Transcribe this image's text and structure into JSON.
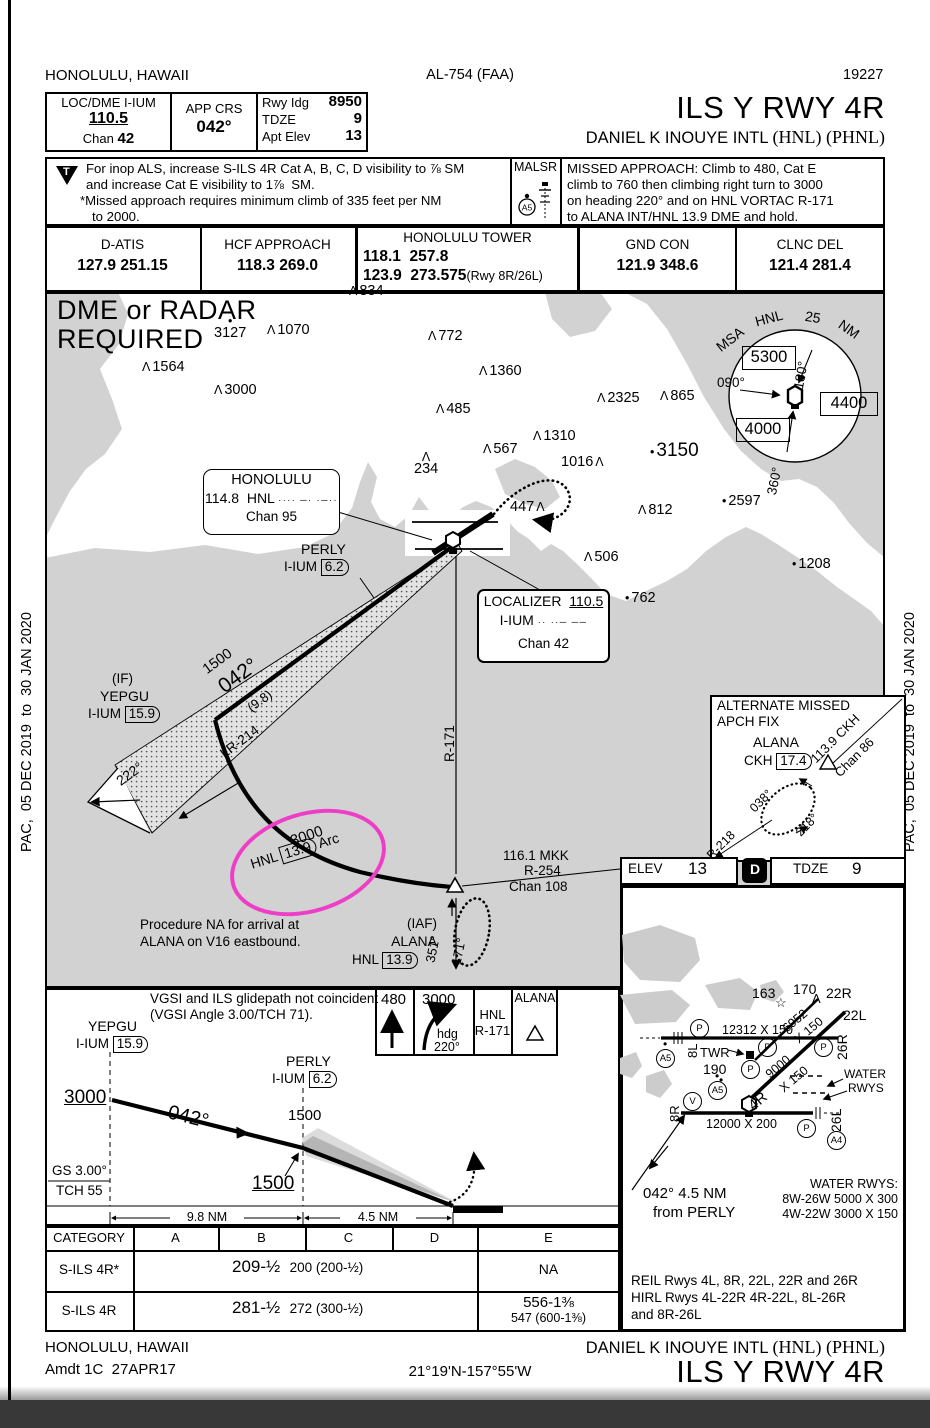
{
  "edge": {
    "left_text": "PAC,  05 DEC 2019  to  30 JAN 2020",
    "right_text": "PAC,  05 DEC 2019  to  30 JAN 2020"
  },
  "header": {
    "city": "HONOLULU, HAWAII",
    "al": "AL-754 (FAA)",
    "num": "19227"
  },
  "title": {
    "proc": "ILS Y RWY 4R",
    "airport": "DANIEL K INOUYE INTL",
    "codes": "(HNL) (PHNL)"
  },
  "briefing": {
    "loc_label": "LOC/DME I-IUM",
    "loc_freq": "110.5",
    "chan_label": "Chan",
    "chan": "42",
    "crs_label": "APP CRS",
    "crs": "042°",
    "rwy_label": "Rwy Idg",
    "rwy": "8950",
    "tdze_label": "TDZE",
    "tdze": "9",
    "elev_label": "Apt Elev",
    "elev": "13"
  },
  "notes": {
    "t": "T",
    "inop1": "For inop ALS, increase S-ILS 4R Cat A, B, C, D visibility to ⅞ SM",
    "inop2": "and increase Cat E visibility to 1⅞  SM.",
    "inop3": "*Missed approach requires minimum climb of 335 feet per NM",
    "inop4": "to 2000.",
    "malsr": "MALSR",
    "malsr_a5": "A5",
    "missed1": "MISSED APPROACH: Climb to 480, Cat E",
    "missed2": "climb to 760 then climbing right turn to 3000",
    "missed3": "on heading 220° and on HNL VORTAC R-171",
    "missed4": "to ALANA INT/HNL 13.9 DME and hold."
  },
  "freqs": {
    "datis_label": "D-ATIS",
    "datis": "127.9 251.15",
    "hcf_label": "HCF APPROACH",
    "hcf": "118.3 269.0",
    "twr_label": "HONOLULU TOWER",
    "twr1": "118.1  257.8",
    "twr2": "123.9  273.575",
    "twr2b": "(Rwy 8R/26L)",
    "gnd_label": "GND CON",
    "gnd": "121.9 348.6",
    "clnc_label": "CLNC DEL",
    "clnc": "121.4 281.4"
  },
  "planview": {
    "req1": "DME or RADAR",
    "req2": "REQUIRED",
    "spots": [
      {
        "s": "p",
        "o": "pre",
        "x": 349,
        "y": 283,
        "v": "834"
      },
      {
        "s": "d",
        "o": "above",
        "x": 214,
        "y": 316,
        "v": "3127"
      },
      {
        "s": "p",
        "o": "pre",
        "x": 267,
        "y": 322,
        "v": "1070"
      },
      {
        "s": "p",
        "o": "pre",
        "x": 428,
        "y": 328,
        "v": "772"
      },
      {
        "s": "p",
        "o": "pre",
        "x": 142,
        "y": 359,
        "v": "1564"
      },
      {
        "s": "p",
        "o": "pre",
        "x": 479,
        "y": 363,
        "v": "1360"
      },
      {
        "s": "p",
        "o": "pre",
        "x": 214,
        "y": 382,
        "v": "3000"
      },
      {
        "s": "p",
        "o": "pre",
        "x": 597,
        "y": 390,
        "v": "2325"
      },
      {
        "s": "p",
        "o": "pre",
        "x": 660,
        "y": 388,
        "v": "865"
      },
      {
        "s": "p",
        "o": "pre",
        "x": 436,
        "y": 401,
        "v": "485"
      },
      {
        "s": "p",
        "o": "pre",
        "x": 533,
        "y": 428,
        "v": "1310"
      },
      {
        "s": "p",
        "o": "pre",
        "x": 483,
        "y": 441,
        "v": "567"
      },
      {
        "s": "d",
        "o": "pre",
        "x": 650,
        "y": 440,
        "v": "3150",
        "big": true
      },
      {
        "s": "p",
        "o": "post",
        "x": 561,
        "y": 454,
        "v": "1016"
      },
      {
        "s": "p",
        "o": "above",
        "x": 414,
        "y": 452,
        "v": "234"
      },
      {
        "s": "p",
        "o": "post",
        "x": 510,
        "y": 499,
        "v": "447"
      },
      {
        "s": "p",
        "o": "pre",
        "x": 638,
        "y": 502,
        "v": "812"
      },
      {
        "s": "d",
        "o": "pre",
        "x": 722,
        "y": 493,
        "v": "2597"
      },
      {
        "s": "p",
        "o": "pre",
        "x": 584,
        "y": 549,
        "v": "506"
      },
      {
        "s": "d",
        "o": "pre",
        "x": 792,
        "y": 556,
        "v": "1208"
      },
      {
        "s": "d",
        "o": "pre",
        "x": 625,
        "y": 590,
        "v": "762"
      }
    ],
    "msa": {
      "t1": "MSA",
      "t2": "HNL",
      "t3": "25",
      "t4": "NM",
      "s1": "5300",
      "s2": "4400",
      "s3": "4000",
      "b1": "180°",
      "b2": "090°",
      "b3": "360°"
    },
    "honolulu": {
      "name": "HONOLULU",
      "freq": "114.8",
      "id": "HNL",
      "morse": "···· ─· ·─··",
      "chan": "Chan 95"
    },
    "perly": {
      "name": "PERLY",
      "id": "I-IUM",
      "dme": "6.2"
    },
    "localizer": {
      "title": "LOCALIZER",
      "freq": "110.5",
      "id": "I-IUM",
      "morse": "·· ··─ ──",
      "chan": "Chan 42"
    },
    "yepgu": {
      "fix_type": "(IF)",
      "name": "YEPGU",
      "id": "I-IUM",
      "dme": "15.9"
    },
    "feather": {
      "alt": "1500",
      "crs": "042°",
      "dist": "(9.8)",
      "lr": "LR-214",
      "recip": "222°"
    },
    "arc": {
      "alt": "3000",
      "navaid": "HNL",
      "dme": "13.9",
      "suffix": "Arc"
    },
    "r171": "R-171",
    "alana": {
      "fix_type": "(IAF)",
      "name": "ALANA",
      "navaid": "HNL",
      "dme": "13.9",
      "in_crs": "351°",
      "out_crs": "171°"
    },
    "mkk": {
      "l1": "116.1 MKK",
      "l2": "R-254",
      "l3": "Chan 108"
    },
    "note1": "Procedure NA for arrival at",
    "note2": "ALANA on V16 eastbound.",
    "alt_missed": {
      "t1": "ALTERNATE MISSED",
      "t2": "APCH FIX",
      "fix": "ALANA",
      "id": "CKH",
      "dme": "17.4",
      "navaid": "113.9 CKH",
      "chan": "Chan 86",
      "in_crs": "038°",
      "out_crs": "218°",
      "radial": "R-218"
    }
  },
  "elevbar": {
    "elev_label": "ELEV",
    "elev": "13",
    "d": "D",
    "tdze_label": "TDZE",
    "tdze": "9"
  },
  "sketch": {
    "rwy_8l26r": "12312 X 150",
    "rwy_8r26l": "12000 X 200",
    "rwy_4r22l_1": "9000",
    "rwy_4r22l_2": "X 150",
    "rwy_4l22r_1": "6952",
    "rwy_4l22r_2": "X 150",
    "l_8l": "8L",
    "l_26r": "26R",
    "l_8r": "8R",
    "l_26l": "26L",
    "l_22r": "22R",
    "l_22l": "22L",
    "l_4r": "4R",
    "e163": "163",
    "e170": "170",
    "e190": "190",
    "star": "☆",
    "caret": "Λ",
    "twr": "TWR",
    "c_a5": "A5",
    "c_a4": "A4",
    "c_p": "P",
    "c_v": "V",
    "water_arrow1": "WATER",
    "water_arrow2": "RWYS",
    "water_title": "WATER RWYS:",
    "water1": "8W-26W 5000 X 300",
    "water2": "4W-22W 3000 X 150",
    "perly1": "042° 4.5 NM",
    "perly2": "from PERLY",
    "lights1": "REIL Rwys 4L, 8R, 22L, 22R and 26R",
    "lights2": "HIRL Rwys 4L-22R 4R-22L, 8L-26R",
    "lights3": "and 8R-26L"
  },
  "profile": {
    "vgsi1": "VGSI and ILS glidepath not coincident",
    "vgsi2": "(VGSI Angle 3.00/TCH 71).",
    "yepgu": "YEPGU",
    "yepgu_id": "I-IUM",
    "yepgu_dme": "15.9",
    "perly": "PERLY",
    "perly_id": "I-IUM",
    "perly_dme": "6.2",
    "alt1": "3000",
    "crs": "042°",
    "alt2": "1500",
    "alt3": "1500",
    "gs": "GS 3.00°",
    "tch": "TCH 55",
    "d1": "9.8 NM",
    "d2": "4.5 NM",
    "ma1": "480",
    "ma2": "3000",
    "ma2b": "hdg",
    "ma2c": "220°",
    "ma3a": "HNL",
    "ma3b": "R-171",
    "ma4": "ALANA"
  },
  "minima": {
    "cols": [
      "CATEGORY",
      "A",
      "B",
      "C",
      "D",
      "E"
    ],
    "r1_cat": "S-ILS 4R*",
    "r1_main": "209-½",
    "r1_paren": "200 (200-½)",
    "r1_e": "NA",
    "r2_cat": "S-ILS 4R",
    "r2_main": "281-½",
    "r2_paren": "272 (300-½)",
    "r2_e1": "556-1⅜",
    "r2_e2": "547 (600-1⅜)"
  },
  "footer": {
    "city": "HONOLULU, HAWAII",
    "amdt": "Amdt 1C  27APR17",
    "coords": "21°19'N-157°55'W",
    "airport": "DANIEL K INOUYE INTL",
    "codes": "(HNL) (PHNL)",
    "proc": "ILS Y RWY 4R"
  },
  "annotation": {
    "highlight_color": "#ee3ec8"
  }
}
